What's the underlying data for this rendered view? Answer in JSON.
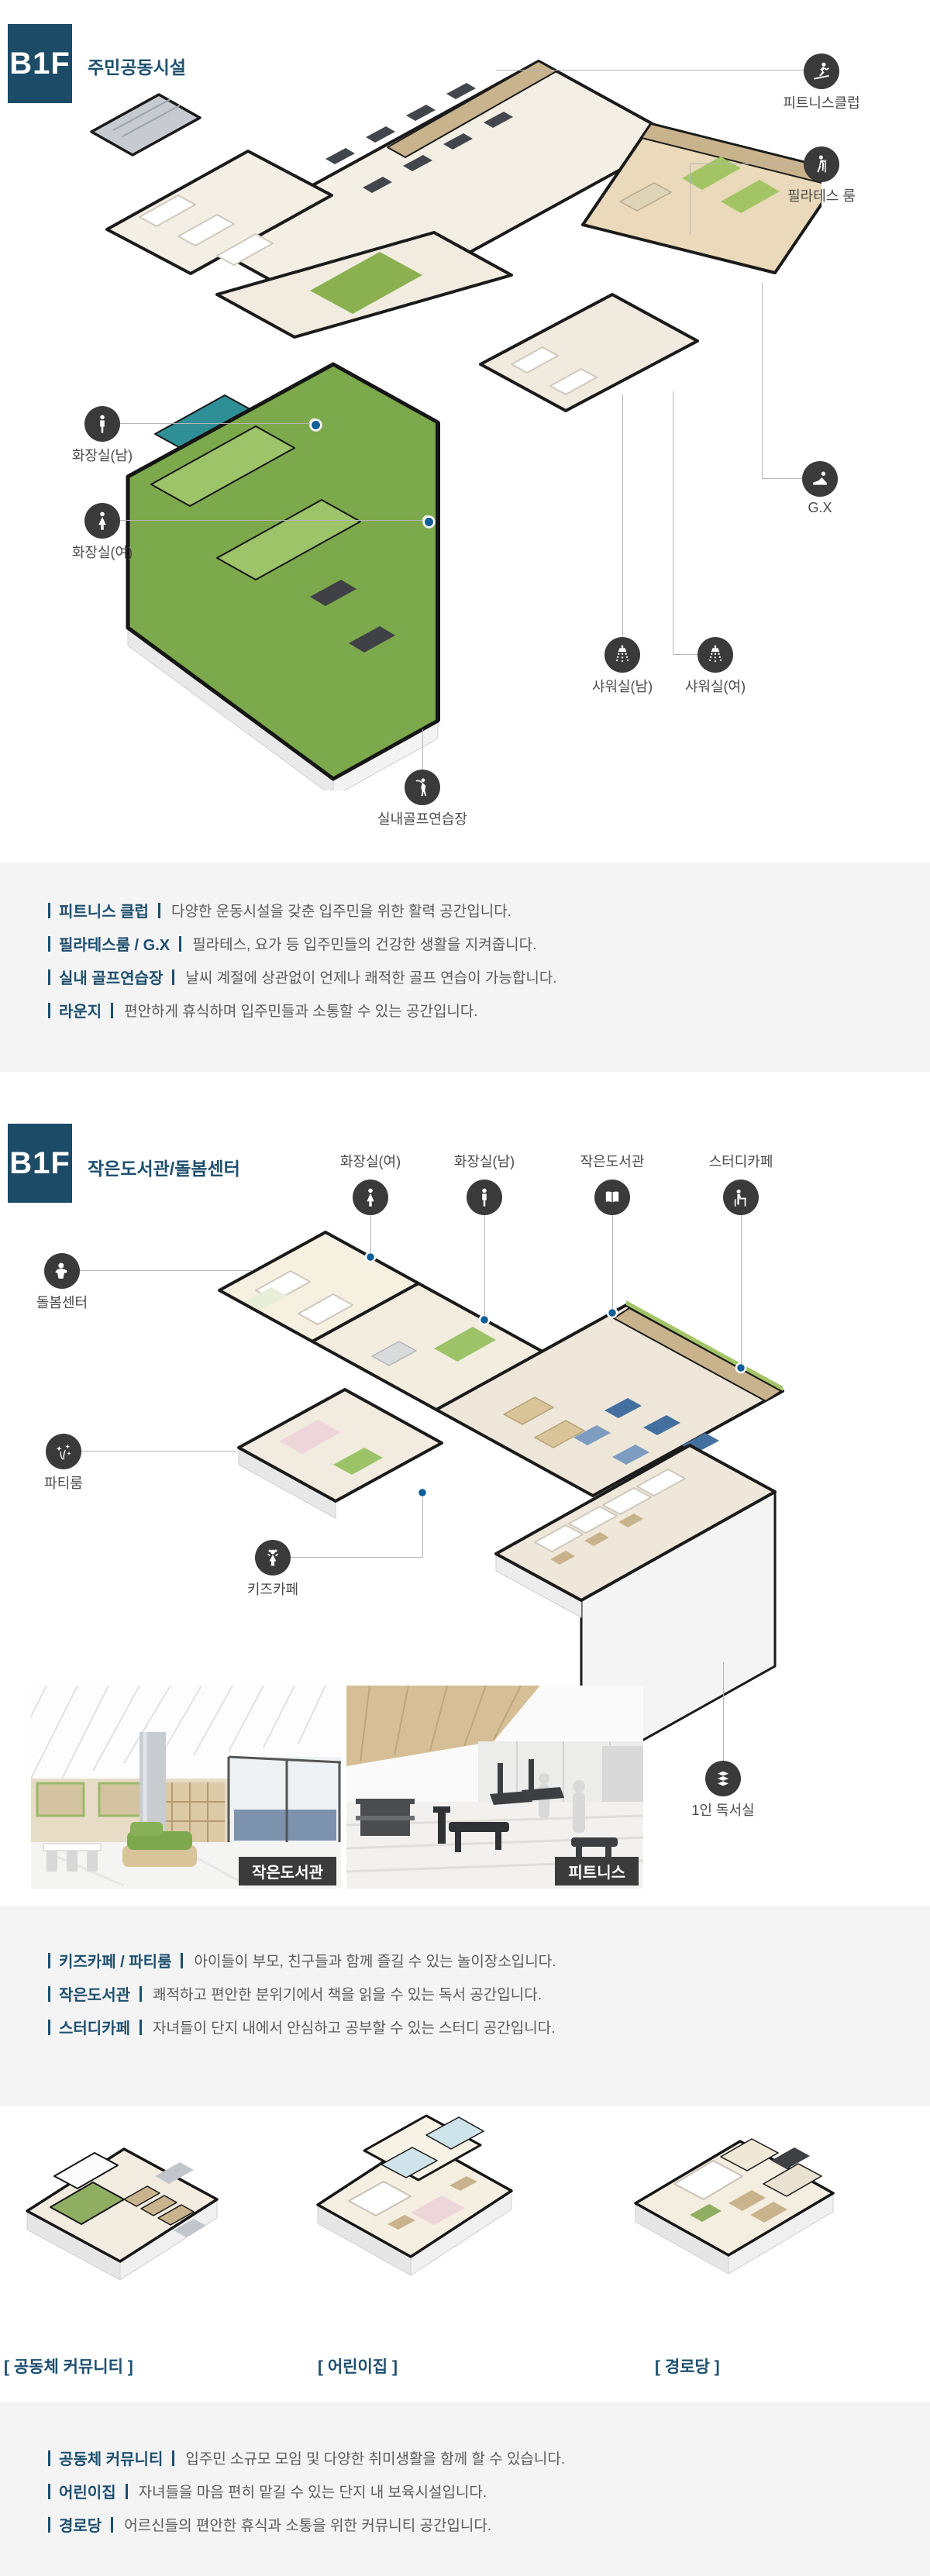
{
  "section1": {
    "floor_label": "B1F",
    "title": "주민공동시설",
    "callouts": [
      {
        "label": "피트니스클럽"
      },
      {
        "label": "필라테스 룸"
      },
      {
        "label": "G.X"
      },
      {
        "label": "화장실(남)"
      },
      {
        "label": "화장실(여)"
      },
      {
        "label": "샤워실(남)"
      },
      {
        "label": "샤워실(여)"
      },
      {
        "label": "실내골프연습장"
      }
    ],
    "descriptions": [
      {
        "label": "피트니스 클럽",
        "text": "다양한 운동시설을 갖춘 입주민을 위한 활력 공간입니다."
      },
      {
        "label": "필라테스룸 / G.X",
        "text": "필라테스, 요가 등 입주민들의 건강한 생활을 지켜줍니다."
      },
      {
        "label": "실내 골프연습장",
        "text": "날씨 계절에 상관없이 언제나 쾌적한 골프 연습이 가능합니다."
      },
      {
        "label": "라운지",
        "text": "편안하게 휴식하며 입주민들과 소통할 수 있는 공간입니다."
      }
    ]
  },
  "section2": {
    "floor_label": "B1F",
    "title": "작은도서관/돌봄센터",
    "callouts": [
      {
        "label": "화장실(여)"
      },
      {
        "label": "화장실(남)"
      },
      {
        "label": "작은도서관"
      },
      {
        "label": "스터디카페"
      },
      {
        "label": "돌봄센터"
      },
      {
        "label": "파티룸"
      },
      {
        "label": "키즈카페"
      },
      {
        "label": "1인 독서실"
      }
    ],
    "photos": [
      {
        "tag": "작은도서관"
      },
      {
        "tag": "피트니스"
      }
    ],
    "descriptions": [
      {
        "label": "키즈카페 / 파티룸",
        "text": "아이들이 부모, 친구들과 함께 즐길 수 있는 놀이장소입니다."
      },
      {
        "label": "작은도서관",
        "text": "쾌적하고 편안한 분위기에서 책을 읽을 수 있는 독서 공간입니다."
      },
      {
        "label": "스터디카페",
        "text": "자녀들이 단지 내에서 안심하고 공부할 수 있는 스터디 공간입니다."
      }
    ]
  },
  "section3": {
    "plan_labels": [
      {
        "label": "[ 공동체 커뮤니티 ]"
      },
      {
        "label": "[ 어린이집 ]"
      },
      {
        "label": "[ 경로당 ]"
      }
    ],
    "descriptions": [
      {
        "label": "공동체 커뮤니티",
        "text": "입주민 소규모 모임 및 다양한 취미생활을 함께 할 수 있습니다."
      },
      {
        "label": "어린이집",
        "text": "자녀들을 마음 편히 맡길 수 있는 단지 내 보육시설입니다."
      },
      {
        "label": "경로당",
        "text": "어르신들의 편안한 휴식과 소통을 위한 커뮤니티 공간입니다."
      }
    ]
  }
}
